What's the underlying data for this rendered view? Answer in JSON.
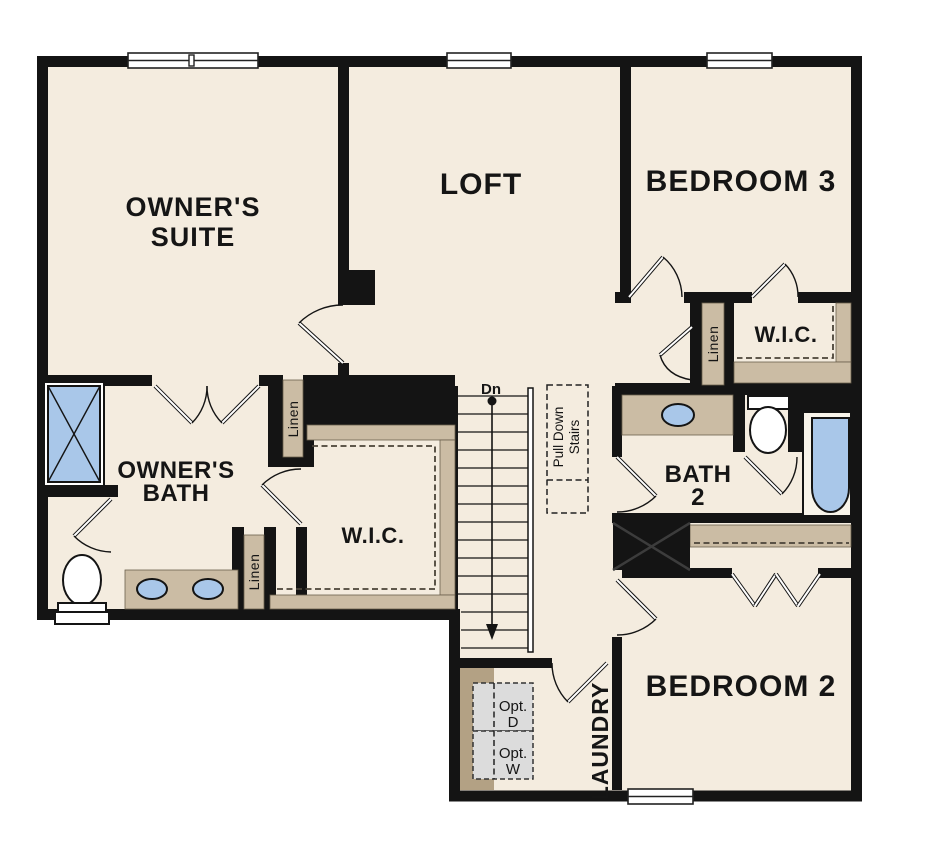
{
  "plan": {
    "rooms": {
      "owners_suite": {
        "line1": "OWNER'S",
        "line2": "SUITE"
      },
      "loft": {
        "label": "LOFT"
      },
      "bedroom3": {
        "label": "BEDROOM 3"
      },
      "bedroom2": {
        "label": "BEDROOM 2"
      },
      "owners_bath": {
        "line1": "OWNER'S",
        "line2": "BATH"
      },
      "bath2": {
        "line1": "BATH",
        "line2": "2"
      },
      "laundry": {
        "label": "LAUNDRY"
      }
    },
    "closets": {
      "owners_wic": {
        "label": "W.I.C."
      },
      "bedroom3_wic": {
        "label": "W.I.C."
      },
      "linen_top": {
        "label": "Linen"
      },
      "linen_bath": {
        "label": "Linen"
      },
      "linen_hall": {
        "label": "Linen"
      }
    },
    "stairs": {
      "down_label": "Dn",
      "pull_down_line1": "Pull Down",
      "pull_down_line2": "Stairs"
    },
    "appliances": {
      "opt_dryer_line1": "Opt.",
      "opt_dryer_line2": "D",
      "opt_washer_line1": "Opt.",
      "opt_washer_line2": "W"
    },
    "colors": {
      "wall": "#141414",
      "floor": "#f4ecdf",
      "cabinetry": "#cbbca4",
      "cabinetry_dark": "#b3a184",
      "fixture_blue": "#a9c7e9",
      "optional_gray": "#dcdcdc",
      "background": "#ffffff"
    }
  }
}
